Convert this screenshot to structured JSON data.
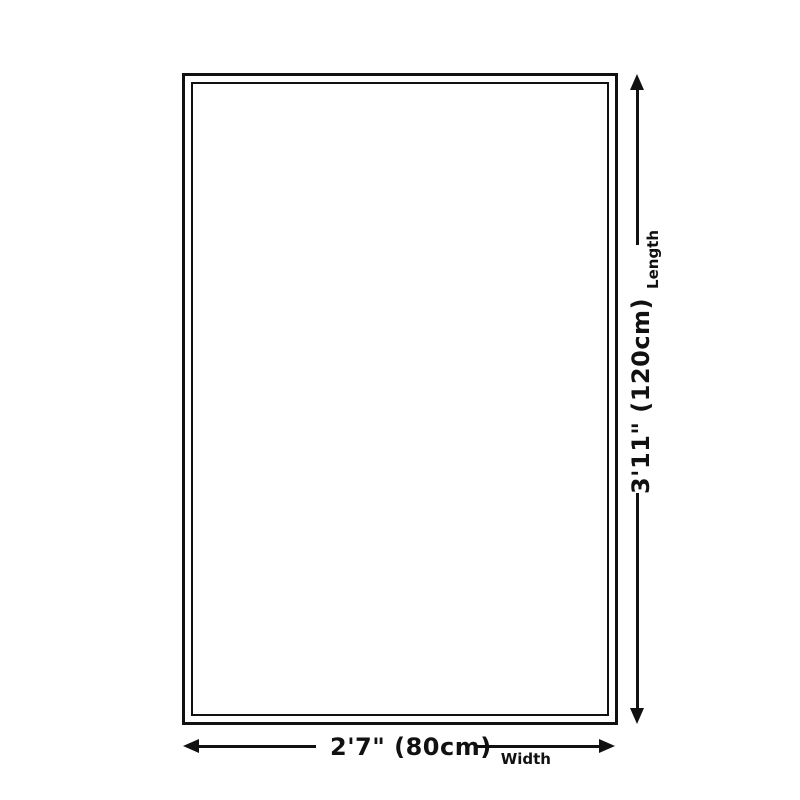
{
  "diagram": {
    "type": "rug-size-dimension-diagram",
    "colors": {
      "line": "#111111",
      "background": "#ffffff"
    },
    "rug": {
      "shape": "rectangle",
      "outline": "double-border"
    },
    "length": {
      "value": "3'11\" (120cm)",
      "axis_label": "Length"
    },
    "width": {
      "value": "2'7\" (80cm)",
      "axis_label": "Width"
    }
  }
}
